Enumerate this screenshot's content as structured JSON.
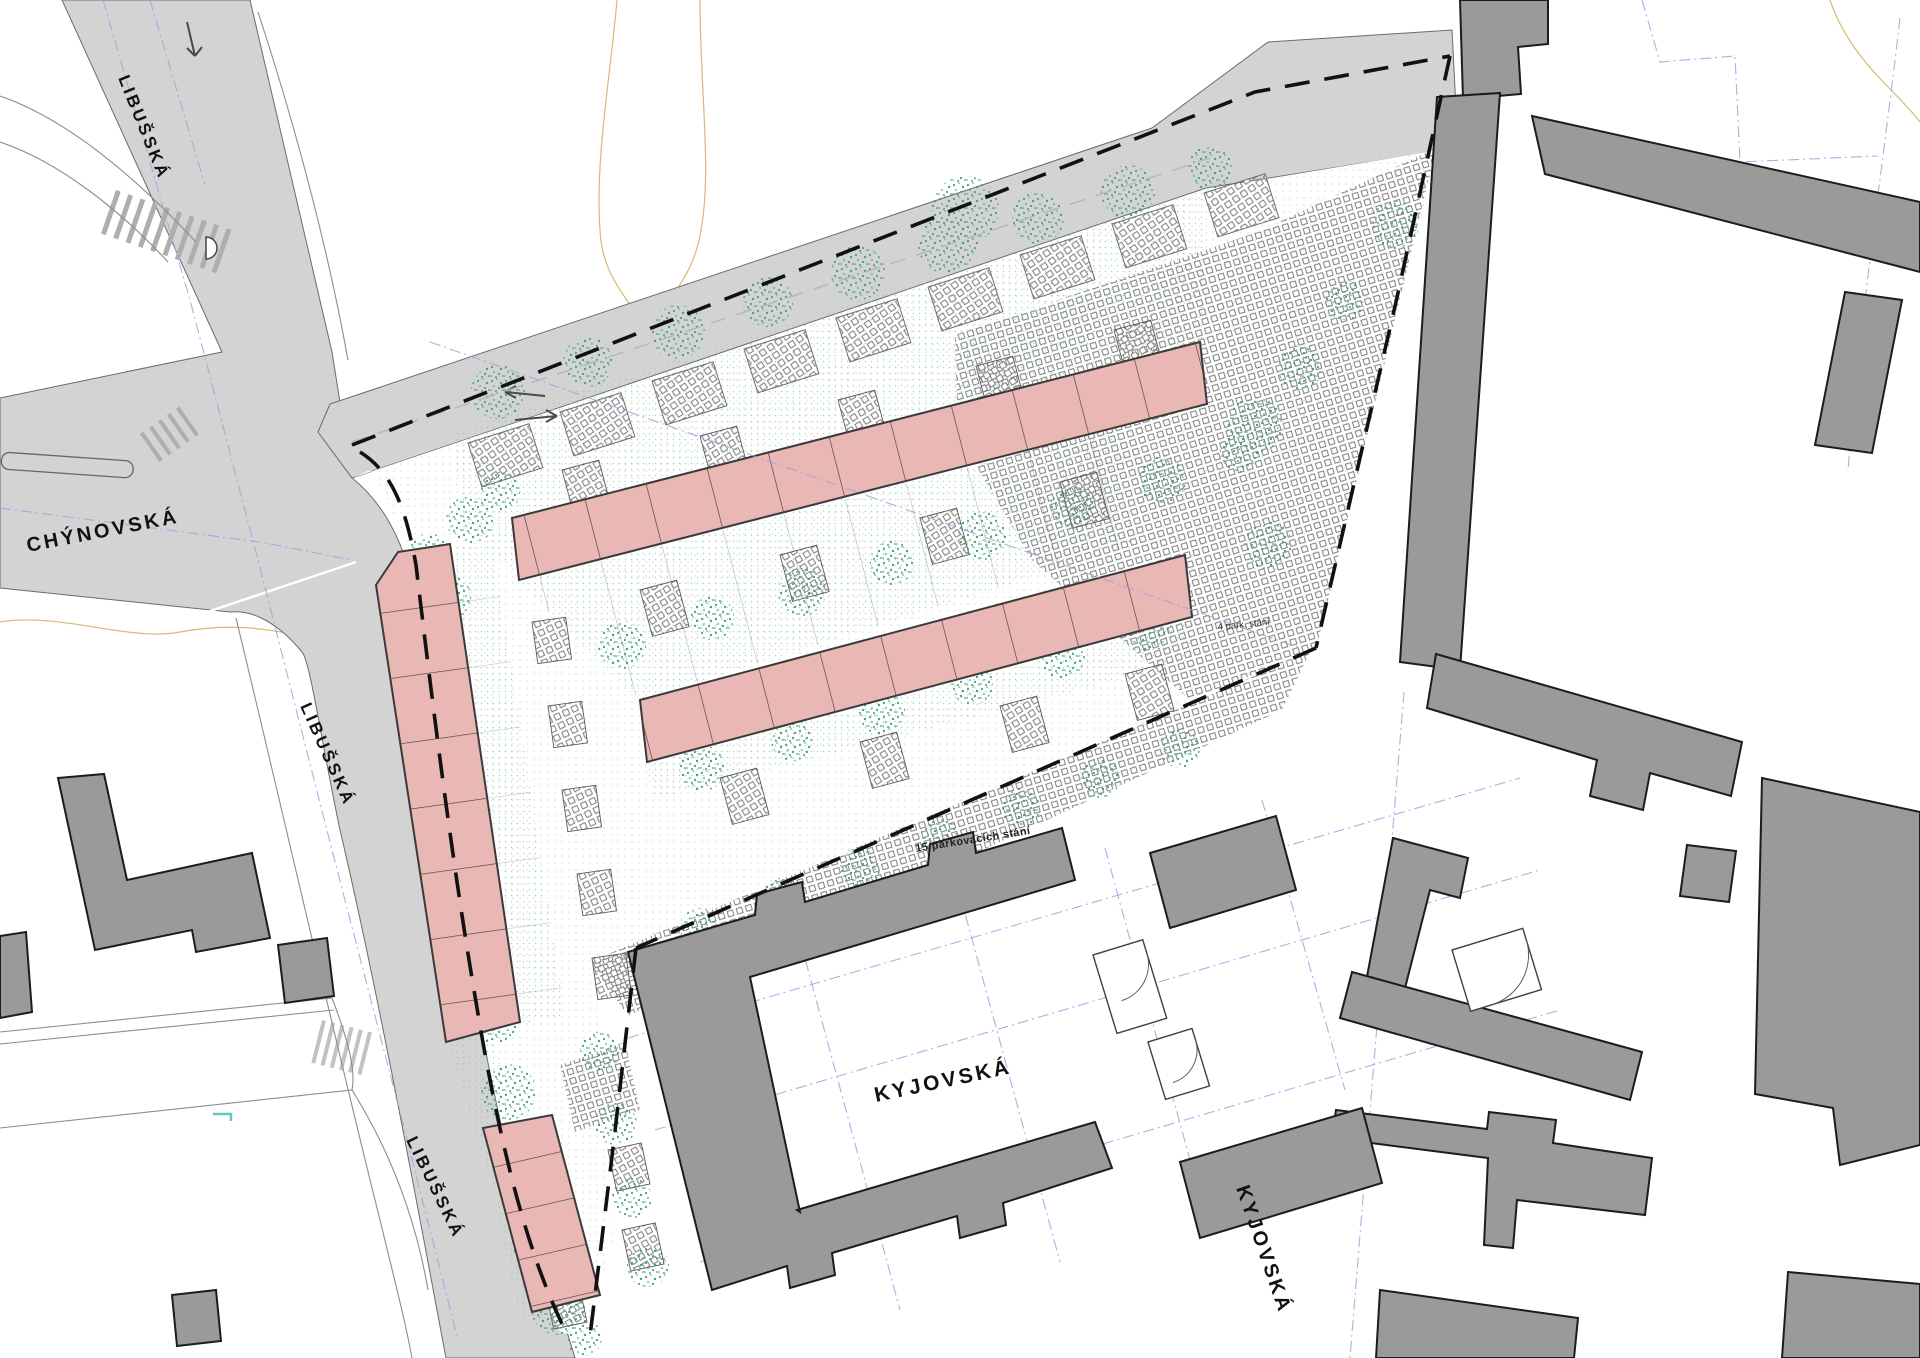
{
  "map": {
    "streets": {
      "libusska_north": "LIBUŠSKÁ",
      "libusska_mid": "LIBUŠSKÁ",
      "libusska_south": "LIBUŠSKÁ",
      "chynovska": "CHÝNOVSKÁ",
      "kyjovska": "KYJOVSKÁ",
      "kyjovska_east": "KYJOVSKÁ"
    },
    "annotations": {
      "parking_4": "4 park. stání",
      "parking_15": "15 parkovacích stání"
    },
    "colors": {
      "road": "#d3d3d3",
      "building_existing": "#9a9a9a",
      "building_proposed_fill": "#e9b7b4",
      "building_proposed_stroke": "#3a3a3a",
      "vegetation": "#44a37e",
      "boundary": "#111111",
      "parcel_line": "#a89ce0",
      "contour": "#d9b878",
      "label": "#111111"
    }
  }
}
